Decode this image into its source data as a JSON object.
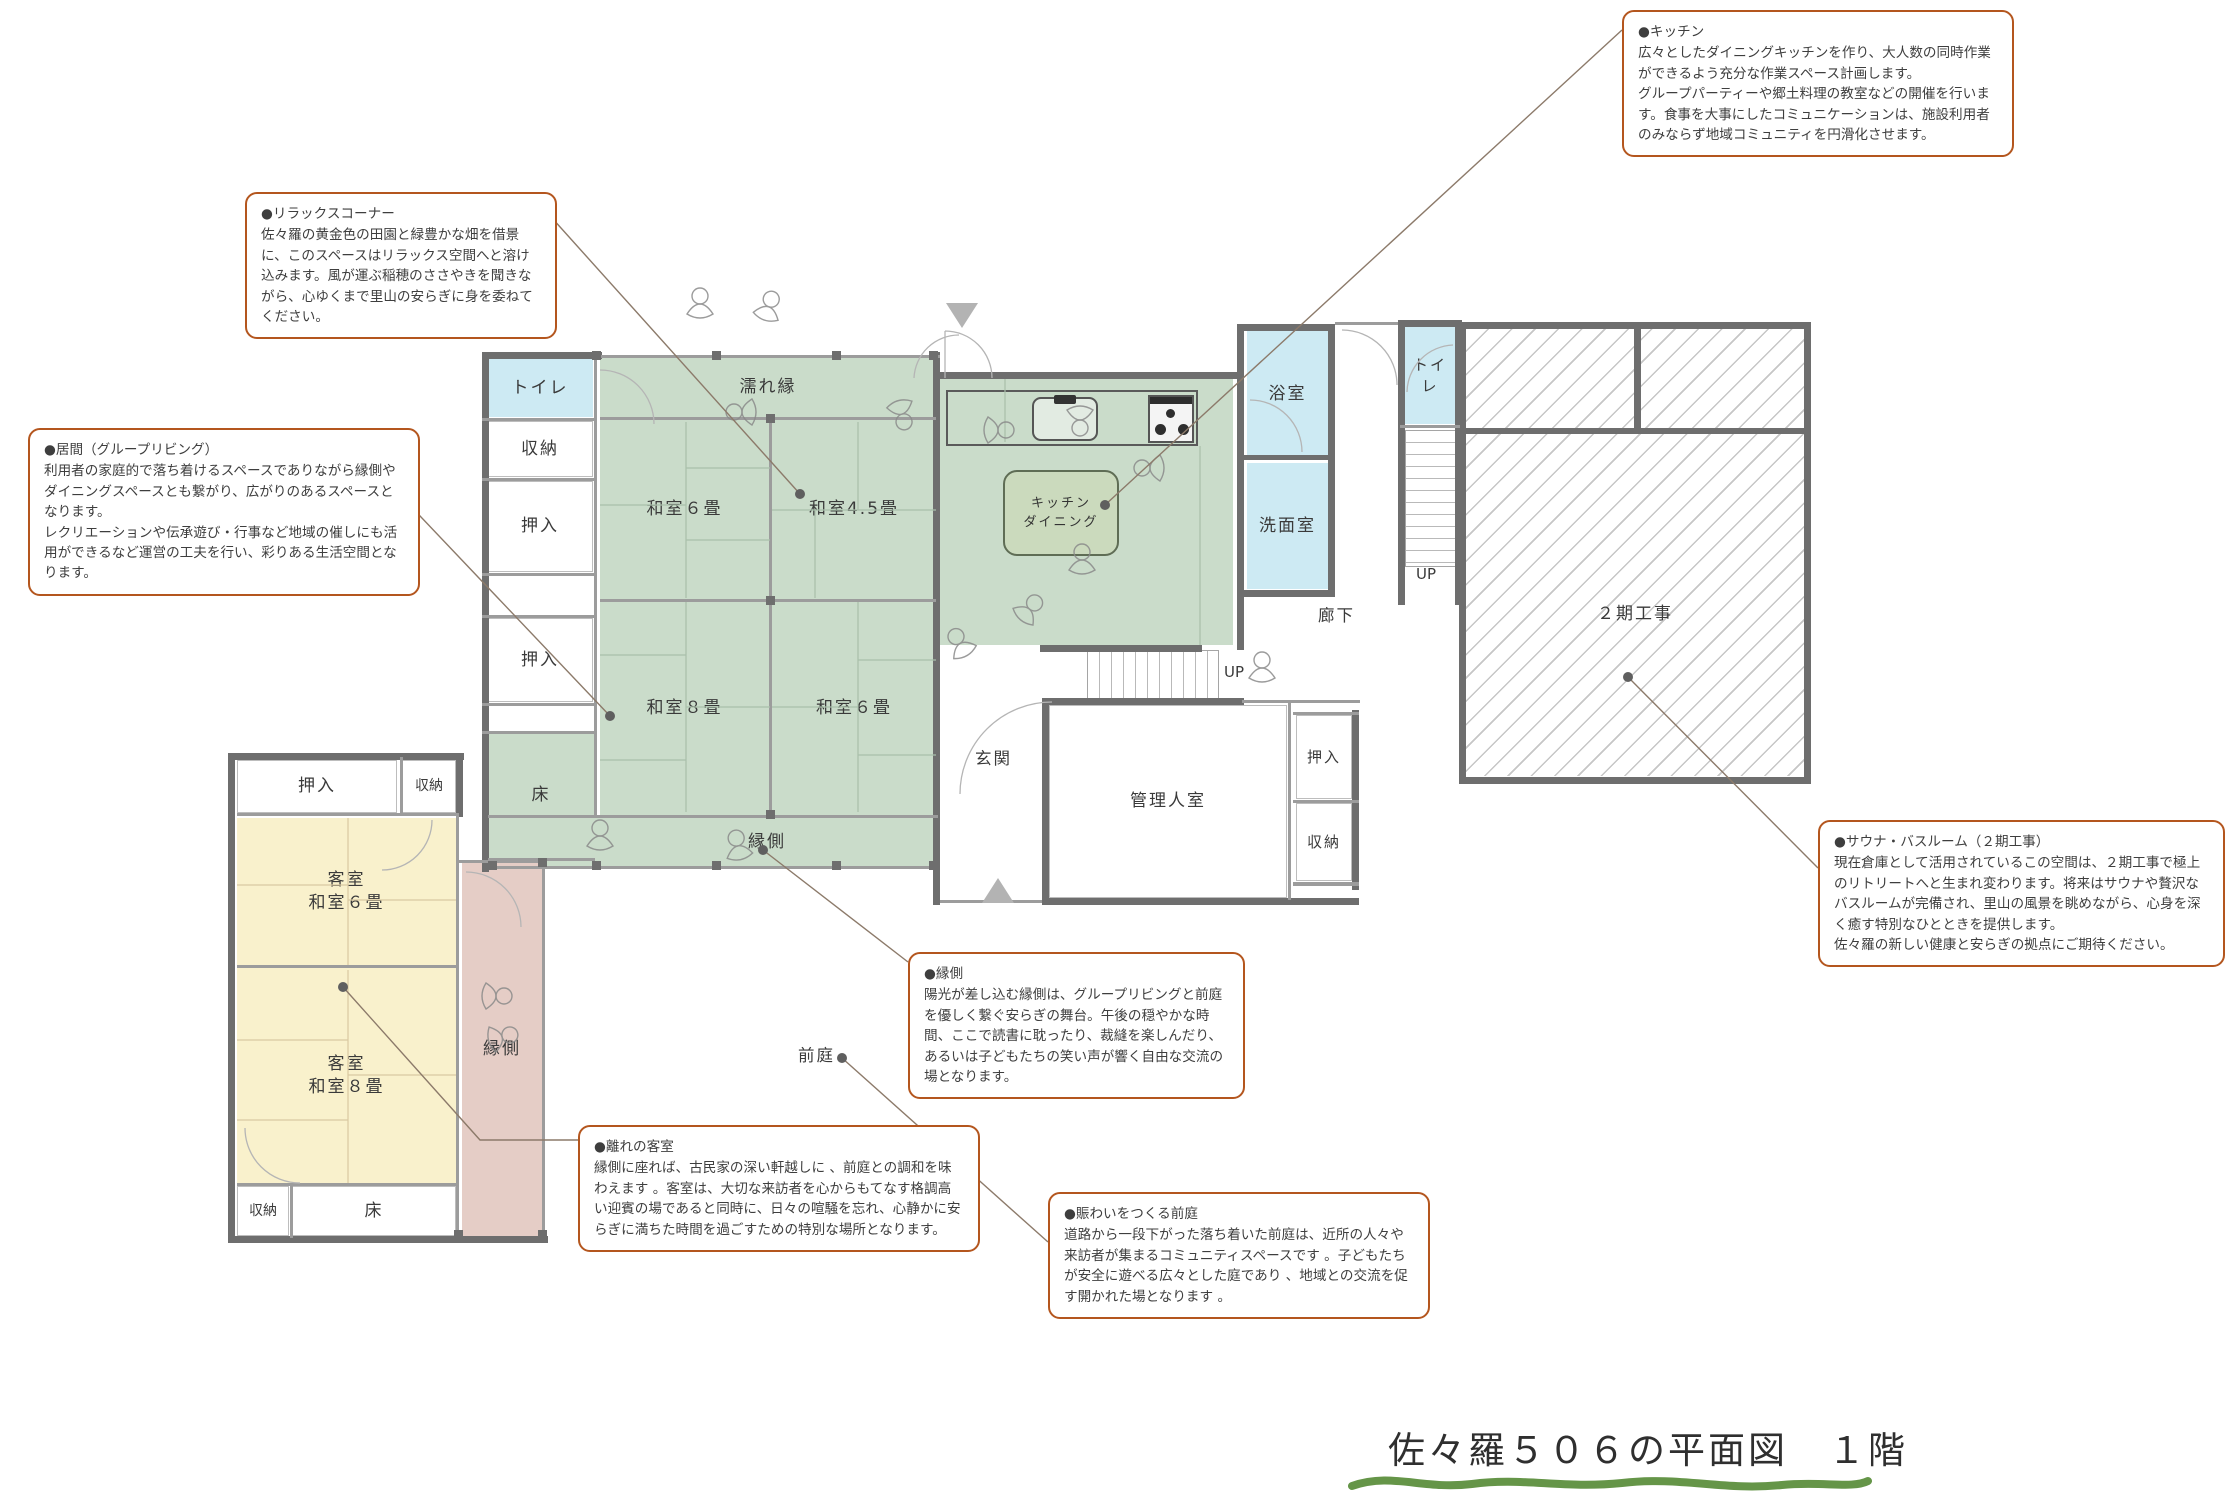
{
  "title": "佐々羅５０６の平面図　１階",
  "callouts": {
    "kitchen": {
      "heading": "●キッチン",
      "body": "広々としたダイニングキッチンを作り、大人数の同時作業ができるよう充分な作業スペース計画します。\nグループパーティーや郷土料理の教室などの開催を行います。食事を大事にしたコミュニケーションは、施設利用者のみならず地域コミュニティを円滑化させます。"
    },
    "relax": {
      "heading": "●リラックスコーナー",
      "body": "佐々羅の黄金色の田園と緑豊かな畑を借景に、このスペースはリラックス空間へと溶け込みます。風が運ぶ稲穂のささやきを聞きながら、心ゆくまで里山の安らぎに身を委ねてください。"
    },
    "living": {
      "heading": "●居間（グループリビング）",
      "body": "利用者の家庭的で落ち着けるスペースでありながら縁側やダイニングスペースとも繋がり、広がりのあるスペースとなります。\nレクリエーションや伝承遊び・行事など地域の催しにも活用ができるなど運営の工夫を行い、彩りある生活空間となります。"
    },
    "sauna": {
      "heading": "●サウナ・バスルーム（２期工事）",
      "body": "現在倉庫として活用されているこの空間は、２期工事で極上のリトリートへと生まれ変わります。将来はサウナや贅沢なバスルームが完備され、里山の風景を眺めながら、心身を深く癒す特別なひとときを提供します。\n佐々羅の新しい健康と安らぎの拠点にご期待ください。"
    },
    "engawa": {
      "heading": "●縁側",
      "body": "陽光が差し込む縁側は、グループリビングと前庭を優しく繋ぐ安らぎの舞台。午後の穏やかな時間、ここで読書に耽ったり、裁縫を楽しんだり、あるいは子どもたちの笑い声が響く自由な交流の場となります。"
    },
    "guest_room": {
      "heading": "●離れの客室",
      "body": "縁側に座れば、古民家の深い軒越しに 、前庭との調和を味わえます 。客室は、大切な来訪者を心からもてなす格調高い迎賓の場であると同時に、日々の喧騒を忘れ、心静かに安らぎに満ちた時間を過ごすための特別な場所となります。"
    },
    "front_garden": {
      "heading": "●賑わいをつくる前庭",
      "body": "道路から一段下がった落ち着いた前庭は、近所の人々や来訪者が集まるコミュニティスペースです 。子どもたちが安全に遊べる広々とした庭であり 、地域との交流を促す開かれた場となります 。"
    }
  },
  "rooms": {
    "toilet_main": "トイレ",
    "storage_nw": "収納",
    "oshiire_nw1": "押入",
    "oshiire_nw2": "押入",
    "toko_main": "床",
    "nureen": "濡れ縁",
    "washitsu6_n": "和室６畳",
    "washitsu45": "和室4.5畳",
    "washitsu8": "和室８畳",
    "washitsu6_s": "和室６畳",
    "engawa_main": "縁側",
    "kitchen_dining": "キッチン\nダイニング",
    "bath": "浴室",
    "washroom": "洗面室",
    "toilet_e": "トイレ",
    "corridor": "廊下",
    "genkan": "玄関",
    "manager": "管理人室",
    "oshiire_e": "押入",
    "storage_e": "収納",
    "phase2": "２期工事",
    "oshiire_annex": "押入",
    "storage_annex_n": "収納",
    "guest6": "客室\n和室６畳",
    "guest8": "客室\n和室８畳",
    "storage_annex_s": "収納",
    "toko_annex": "床",
    "engawa_annex": "縁側",
    "front_garden": "前庭",
    "up_right": "UP",
    "up_mid": "UP"
  },
  "colors": {
    "callout_border": "#b4561e",
    "tatami_green": "#cadcca",
    "guest_yellow": "#f9f1cc",
    "engawa_pink": "#e5cdc6",
    "water_cyan": "#cdeaf3",
    "wall_gray": "#6e6e6e",
    "underline_green": "#5d8f3e"
  }
}
